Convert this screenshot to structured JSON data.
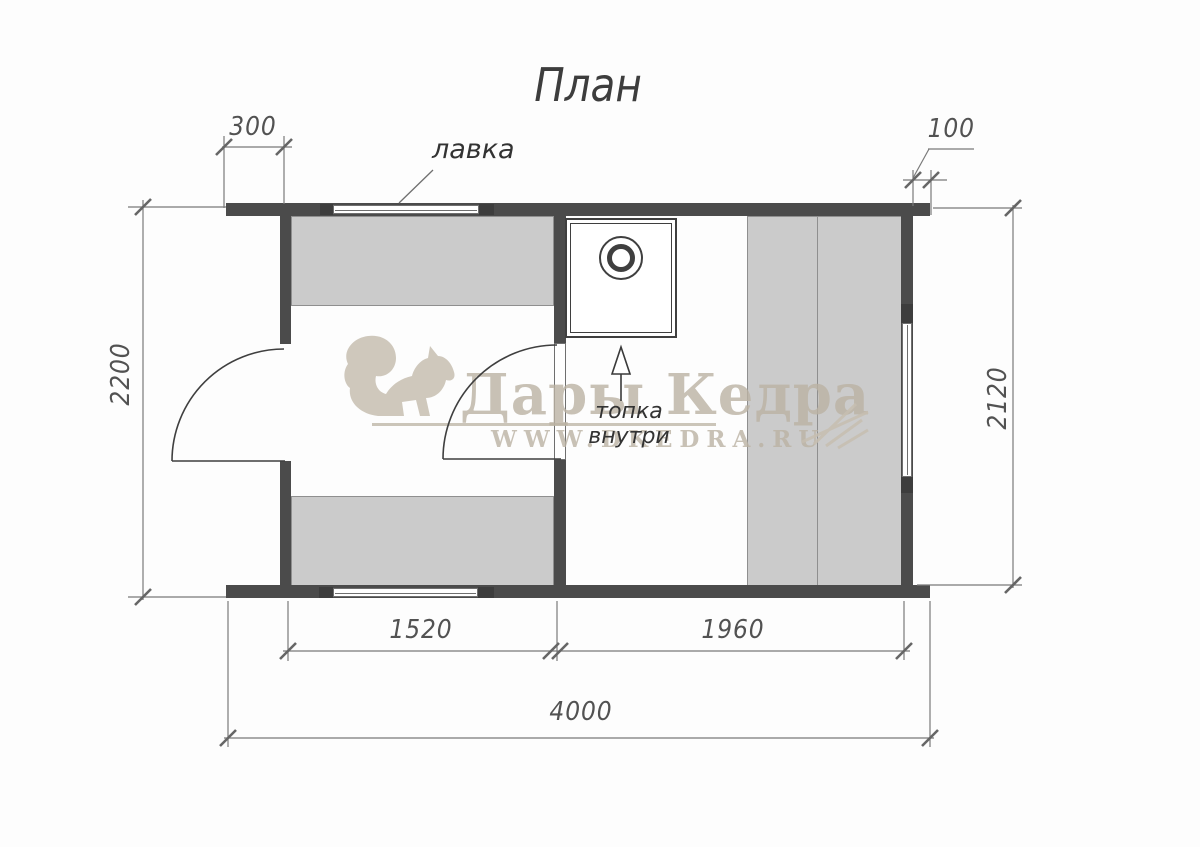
{
  "title": "План",
  "annotations": {
    "bench_label": "лавка",
    "stove_label": "топка внутри"
  },
  "dimensions": {
    "top_left_offset": "300",
    "top_right_offset": "100",
    "left_height": "2200",
    "right_height": "2120",
    "left_room_width": "1520",
    "right_room_width": "1960",
    "total_width": "4000"
  },
  "watermark": {
    "brand": "Дары Кедра",
    "website": "WWW.DKEDRA.RU"
  },
  "colors": {
    "wall": "#4b4b4b",
    "bench_fill": "#cbcbcb",
    "dimension_line": "#767676",
    "dimension_text": "#545454",
    "watermark_beige": "#c8c0b2",
    "background": "#ffffff"
  }
}
